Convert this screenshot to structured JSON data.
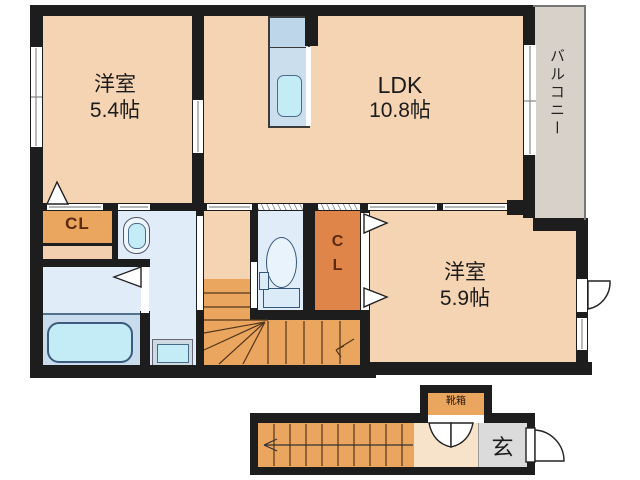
{
  "floor_plan": {
    "rooms": {
      "bedroom1": {
        "name": "洋室",
        "size": "5.4帖"
      },
      "ldk": {
        "name": "LDK",
        "size": "10.8帖"
      },
      "bedroom2": {
        "name": "洋室",
        "size": "5.9帖"
      },
      "balcony": {
        "label": "バルコニー"
      },
      "closet1": {
        "label": "CL"
      },
      "closet2": {
        "char1": "C",
        "char2": "L"
      },
      "entrance": {
        "label": "玄"
      },
      "shoebox": {
        "label": "靴箱"
      }
    },
    "palette": {
      "wall": "#1d1d1d",
      "room_floor": "#f5d4b3",
      "stairs_closet_orange": "#eaa55f",
      "center_closet_orange": "#e0854a",
      "wet_area_blue": "#e0edf8",
      "bath_floor_blue": "#c9dced",
      "fixture_cyan": "#c3ecf6",
      "balcony_gray": "#d7d1c9",
      "entrance_gray": "#dbdbdb",
      "landing_peach": "#f7e3ca"
    }
  }
}
